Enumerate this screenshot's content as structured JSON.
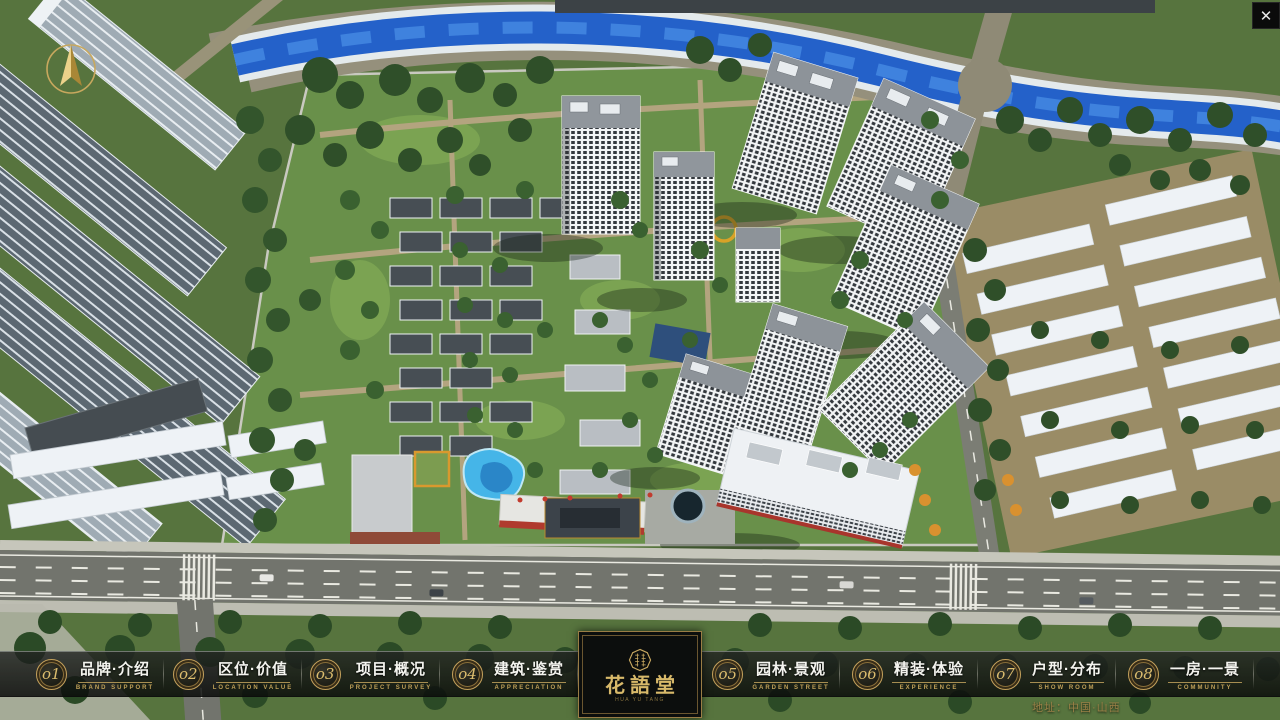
{
  "window": {
    "close_icon": "✕"
  },
  "nav": {
    "items": [
      {
        "number": "o1",
        "title": "品牌·介绍",
        "subtitle": "BRAND SUPPORT"
      },
      {
        "number": "o2",
        "title": "区位·价值",
        "subtitle": "LOCATION VALUE"
      },
      {
        "number": "o3",
        "title": "项目·概况",
        "subtitle": "PROJECT SURVEY"
      },
      {
        "number": "o4",
        "title": "建筑·鉴赏",
        "subtitle": "APPRECIATION"
      },
      {
        "number": "o5",
        "title": "园林·景观",
        "subtitle": "GARDEN STREET"
      },
      {
        "number": "o6",
        "title": "精装·体验",
        "subtitle": "EXPERIENCE"
      },
      {
        "number": "o7",
        "title": "户型·分布",
        "subtitle": "SHOW ROOM"
      },
      {
        "number": "o8",
        "title": "一房·一景",
        "subtitle": "COMMUNITY"
      }
    ],
    "logo": {
      "title": "花語堂",
      "caption": "HUA YU TANG"
    }
  },
  "footer": {
    "address": "地址：中国·山西"
  },
  "theme": {
    "gold": "#C9A961",
    "gold_dim": "#9B8147",
    "bar_background": "rgba(14,16,14,0.84)",
    "text_light": "#F4F4EF",
    "river_blue": "#2461C9",
    "tree_green": "#2F4F29"
  }
}
